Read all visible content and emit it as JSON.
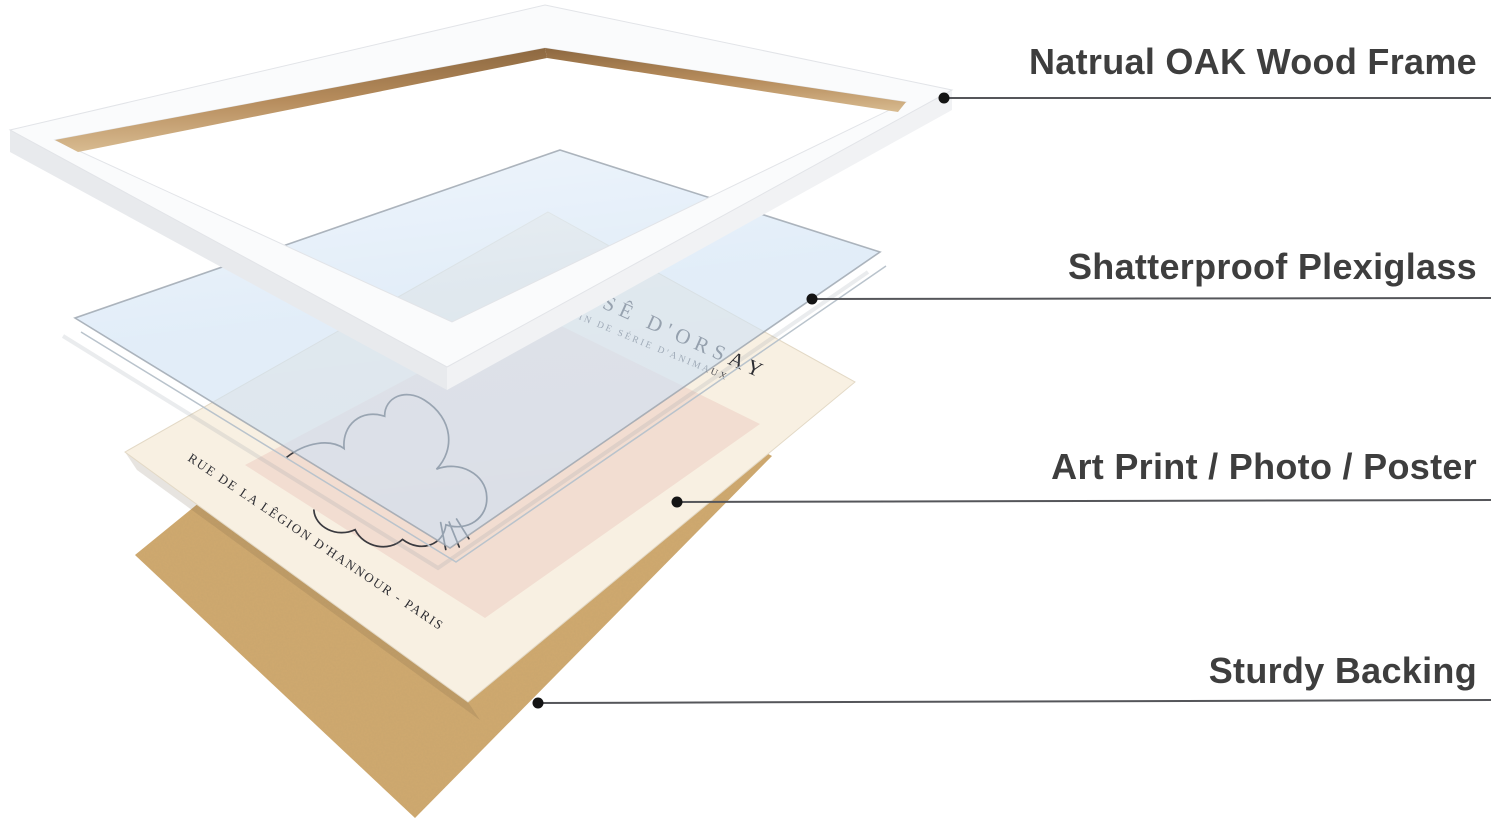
{
  "diagram": {
    "callouts": [
      {
        "label": "Natrual OAK Wood Frame"
      },
      {
        "label": "Shatterproof Plexiglass"
      },
      {
        "label": "Art Print / Photo / Poster"
      },
      {
        "label": "Sturdy Backing"
      }
    ],
    "poster": {
      "title": "USÊ D'ORSAY",
      "subtitle": "SSIN DE SÉRIE D'ANIMAUX",
      "footer": "RUE DE LA LÊGION D'HANNOUR - PARIS"
    },
    "colors": {
      "frame_face": "#fafbfc",
      "frame_side": "#e8eaed",
      "frame_side_light": "#f1f2f4",
      "oak_wood": "#a97f4f",
      "plexiglass": "#cde1f4",
      "print_paper": "#f8f0e2",
      "print_panel": "#f2ddd1",
      "backing_kraft": "#d0a96f",
      "callout_line": "#55565a",
      "label_text": "#3e3e3e"
    }
  }
}
